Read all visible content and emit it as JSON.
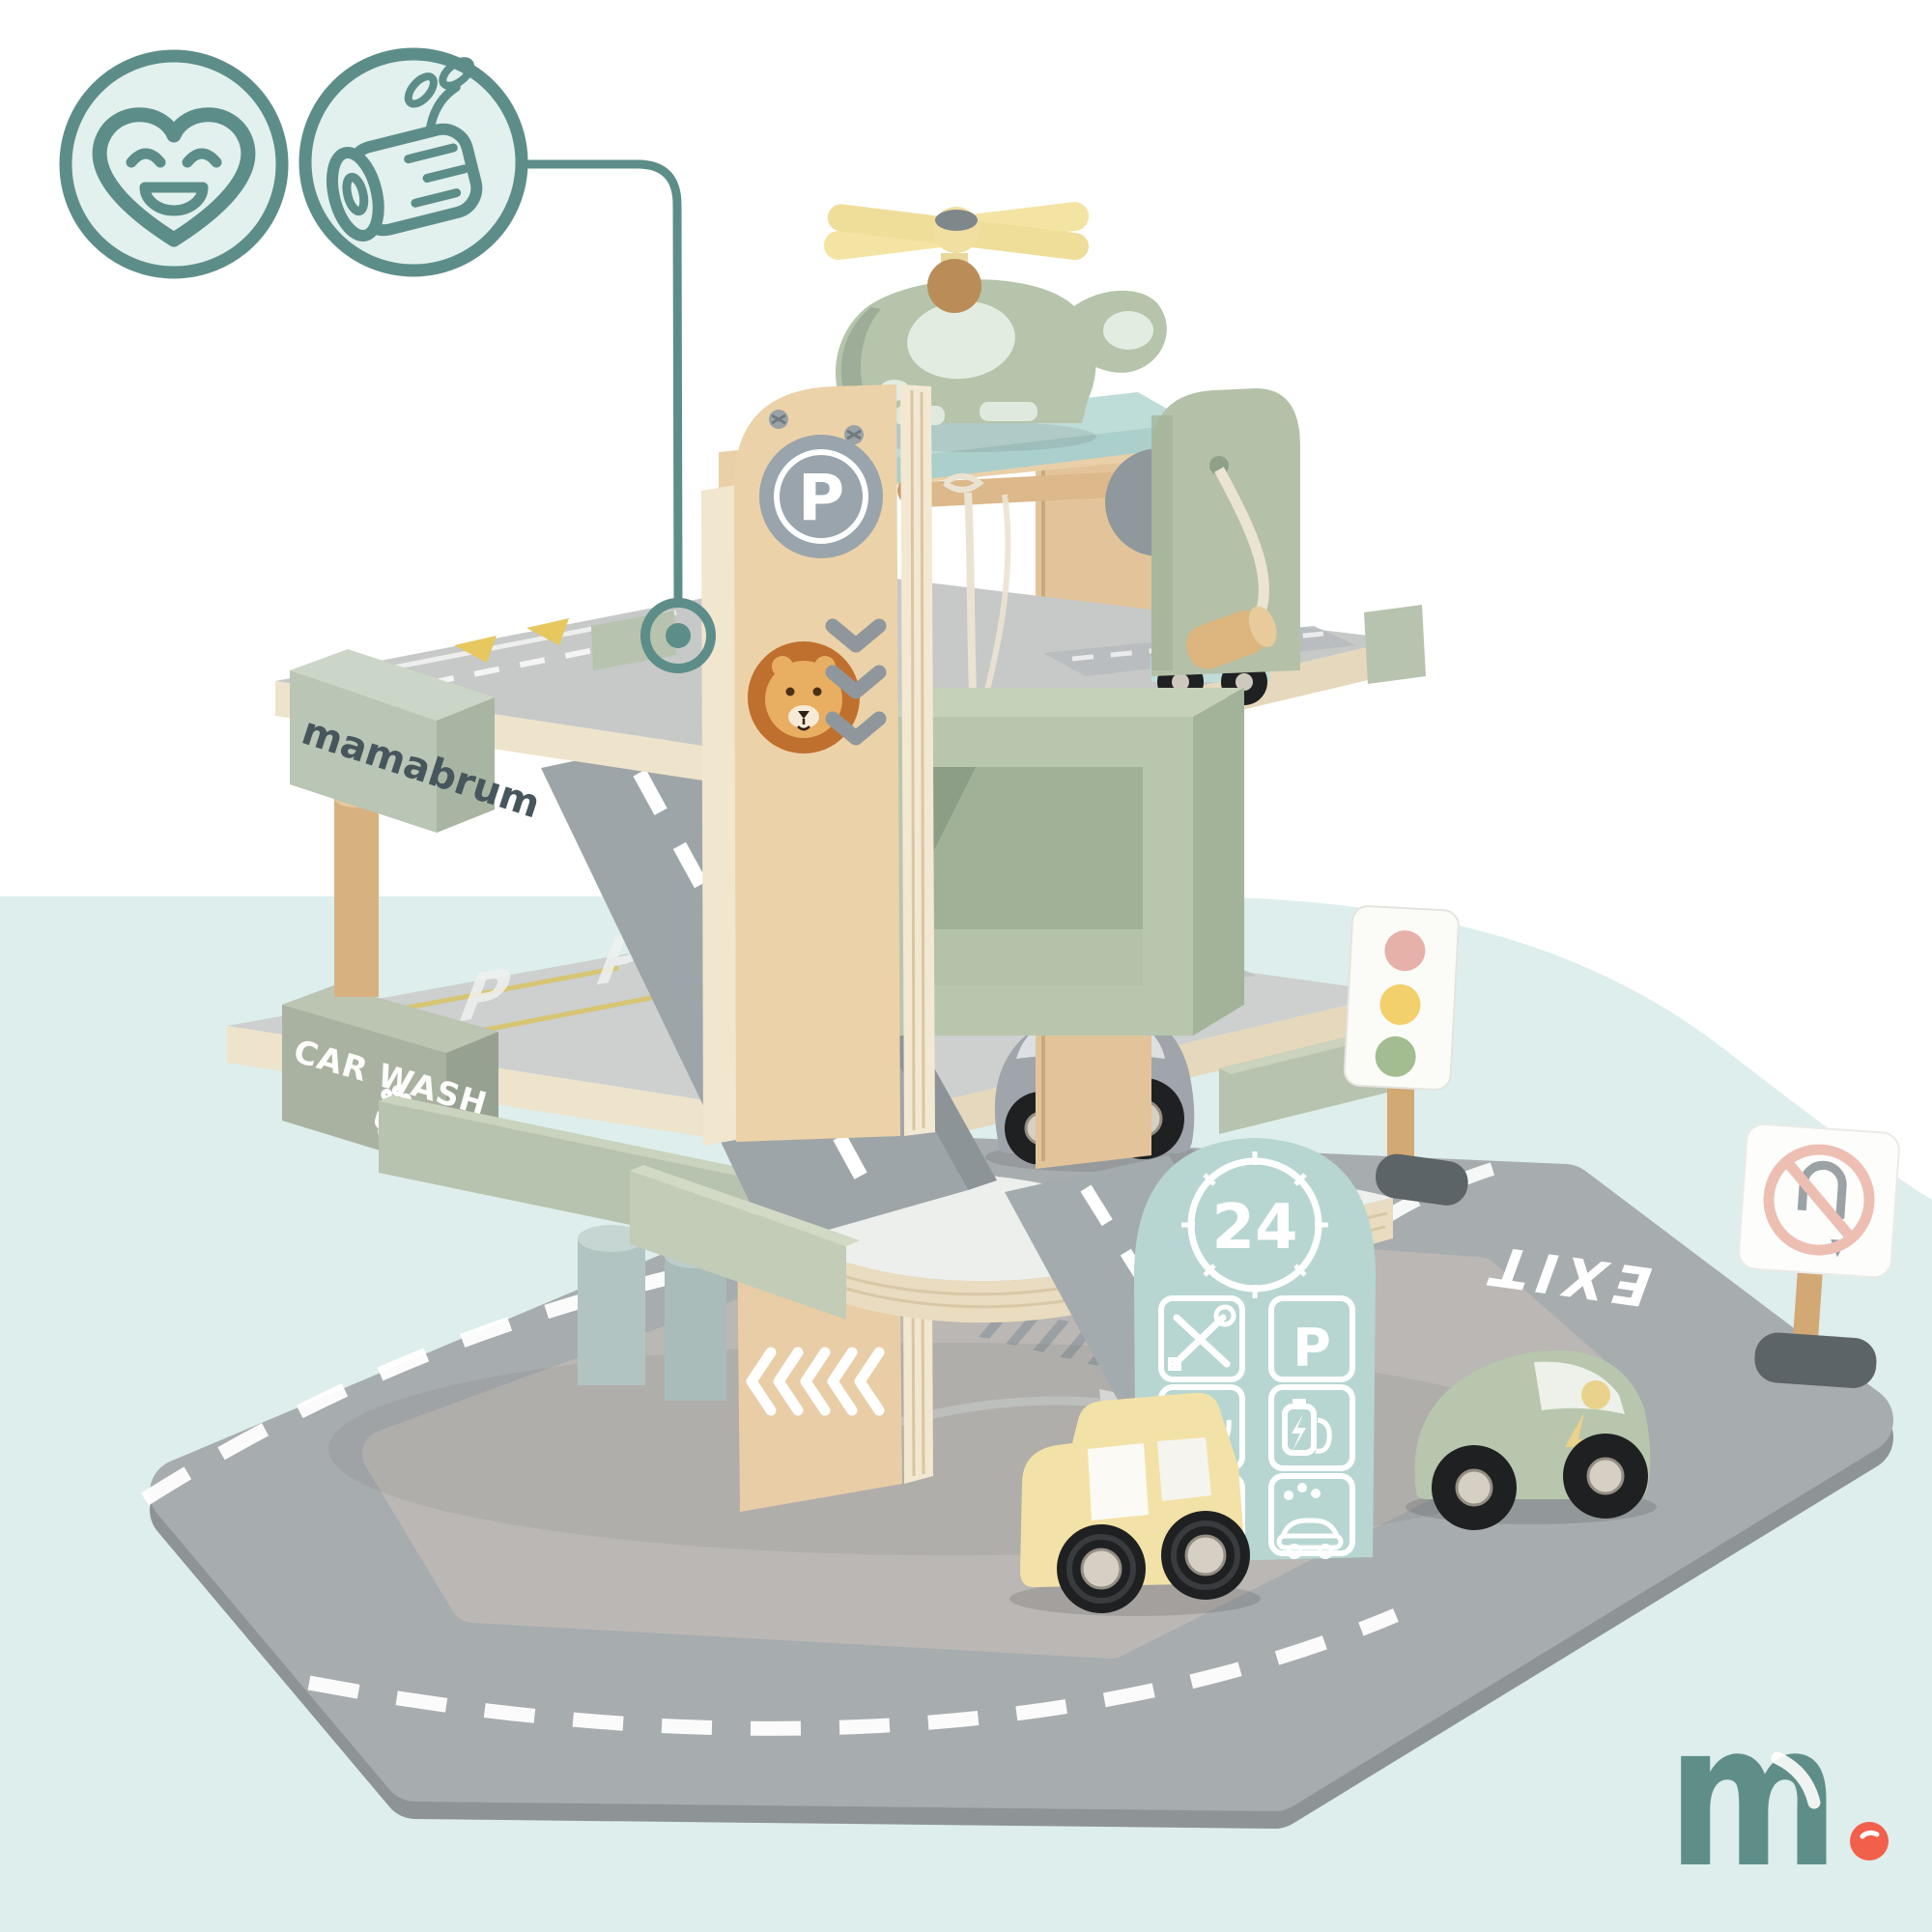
{
  "background": {
    "top_color": "#ffffff",
    "panel_color": "#ddeeec"
  },
  "feature_icons": {
    "accent_color": "#5d8d89",
    "fill_color": "#e2f1ee",
    "left_icon": "smiling-heart",
    "right_icon": "natural-wood-log"
  },
  "toy": {
    "brand": "mamabrum",
    "signs": {
      "car_wash": "CAR WASH",
      "parking_badge": "P",
      "service_hours": "24",
      "service_parking": "P",
      "exit": "EXIT"
    },
    "deck_markings": {
      "parking_1": "P",
      "parking_2": "P"
    },
    "colors": {
      "birch_wood": "#ecd2a9",
      "sage_green": "#b7c3ad",
      "mint": "#bcd8d4",
      "road_gray": "#a7acaf",
      "traffic_light_pink": "#e5b1a9",
      "traffic_light_yellow": "#f2d06b",
      "traffic_light_green": "#a3bd90",
      "car_yellow": "#f3e2a7",
      "car_gray": "#9fa5ab",
      "car_green": "#b8c6ad"
    }
  },
  "logo": {
    "letter": "m",
    "color": "#5f8e89",
    "dot_color": "#f2604b"
  }
}
